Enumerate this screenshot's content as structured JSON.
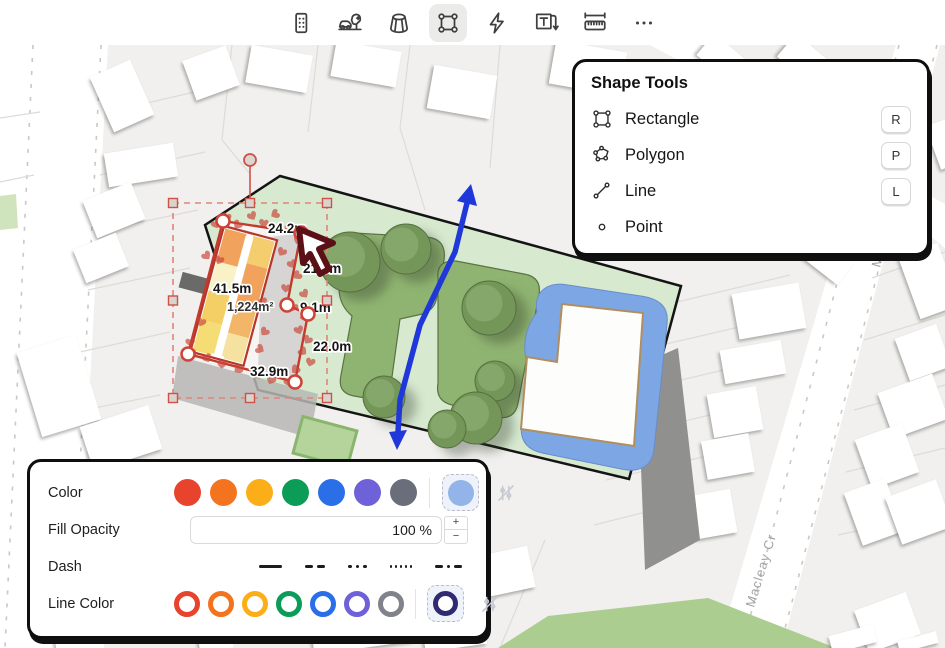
{
  "toolbar": {
    "tools": [
      {
        "icon": "building-icon",
        "active": false
      },
      {
        "icon": "car-tree-icon",
        "active": false
      },
      {
        "icon": "prism-icon",
        "active": false
      },
      {
        "icon": "rectangle-select-icon",
        "active": true
      },
      {
        "icon": "lightning-icon",
        "active": false
      },
      {
        "icon": "text-annotation-icon",
        "active": false
      },
      {
        "icon": "measure-icon",
        "active": false
      },
      {
        "icon": "more-icon",
        "active": false
      }
    ]
  },
  "shape_tools_panel": {
    "title": "Shape Tools",
    "items": [
      {
        "icon": "rectangle-icon",
        "label": "Rectangle",
        "shortcut": "R"
      },
      {
        "icon": "polygon-icon",
        "label": "Polygon",
        "shortcut": "P"
      },
      {
        "icon": "line-icon",
        "label": "Line",
        "shortcut": "L"
      },
      {
        "icon": "point-icon",
        "label": "Point",
        "shortcut": ""
      }
    ]
  },
  "style_panel": {
    "color_label": "Color",
    "fill_opacity_label": "Fill Opacity",
    "fill_opacity_value": "100 %",
    "dash_label": "Dash",
    "line_color_label": "Line Color",
    "stepper": {
      "plus": "+",
      "minus": "−"
    },
    "fill_colors": [
      "#e8432d",
      "#f4731f",
      "#fbae17",
      "#0b9d58",
      "#2a6ee8",
      "#6f61d8",
      "#6a6e7a"
    ],
    "fill_selected": "#92b4e8",
    "line_colors": [
      "#e8432d",
      "#f4731f",
      "#fbae17",
      "#0b9d58",
      "#2a6ee8",
      "#6f61d8",
      "#80838c"
    ],
    "line_selected": "#2f2a72",
    "dash_styles": [
      "solid",
      "dash",
      "dot",
      "fine-dot",
      "dash-dot"
    ]
  },
  "map": {
    "street_label": "Macleay Cr",
    "measurements": {
      "top": "24.2m",
      "upper_right": "21.3m",
      "left": "41.5m",
      "area": "1,224m²",
      "notch": "9.1m",
      "right": "22.0m",
      "bottom": "32.9m"
    }
  }
}
